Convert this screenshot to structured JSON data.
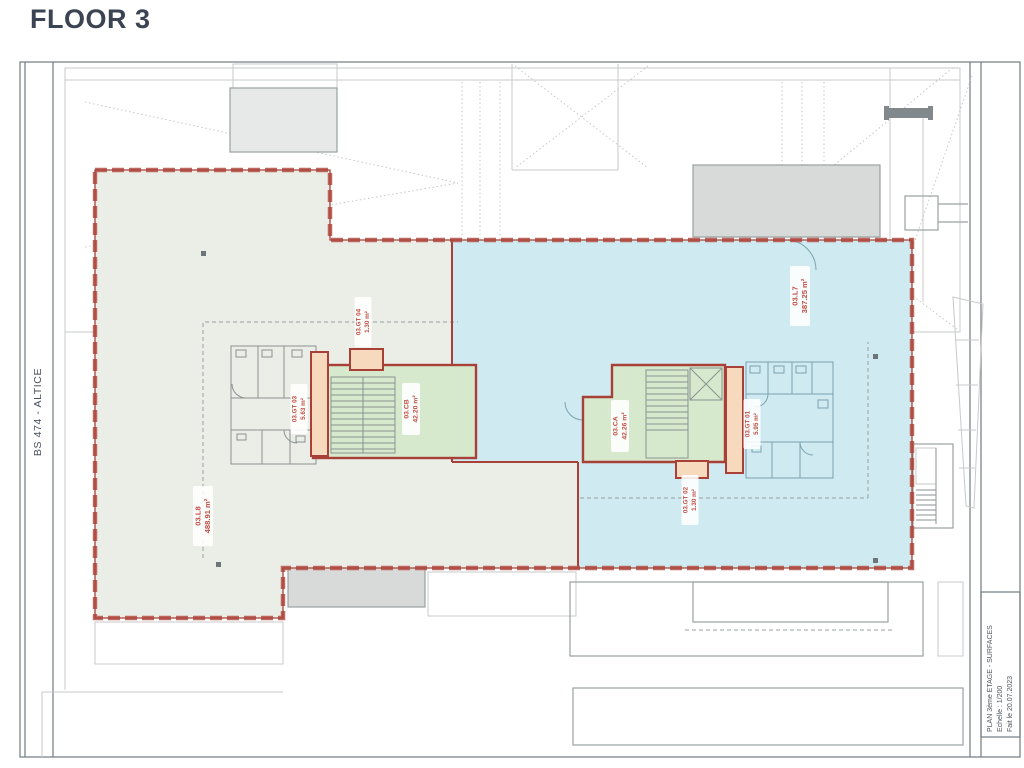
{
  "page": {
    "title": "FLOOR 3"
  },
  "side_strip": {
    "label": "BS 474 - ALTICE"
  },
  "title_block": {
    "line1": "PLAN 3ème ETAGE - SURFACES",
    "line2": "Echelle : 1/200",
    "line3": "Fait le 20.07.2023"
  },
  "plan": {
    "labels": [
      {
        "code": "03.L8",
        "area": "488.91 m²"
      },
      {
        "code": "03.L7",
        "area": "387.25 m²"
      },
      {
        "code": "03.CB",
        "area": "42.20 m²"
      },
      {
        "code": "03.CA",
        "area": "42.26 m²"
      },
      {
        "code": "03.GT 03",
        "area": "5.63 m²"
      },
      {
        "code": "03.GT 04",
        "area": "1.30 m²"
      },
      {
        "code": "03.GT 01",
        "area": "5.95 m²"
      },
      {
        "code": "03.GT 02",
        "area": "1.30 m²"
      }
    ],
    "colors": {
      "zone_grey": "#ebede7",
      "zone_blue": "#cfeaf0",
      "core_green": "#d6e9cd",
      "shaft_orange": "#f7d9bd",
      "outline_red": "#a84038",
      "facade_red": "#b5544a",
      "label_red": "#c24b41",
      "linework_grey": "#9aa0a1",
      "roof_grey": "#c7cac8",
      "toilet_blue": "#7ba3b1",
      "title_text": "#3b4453"
    }
  }
}
